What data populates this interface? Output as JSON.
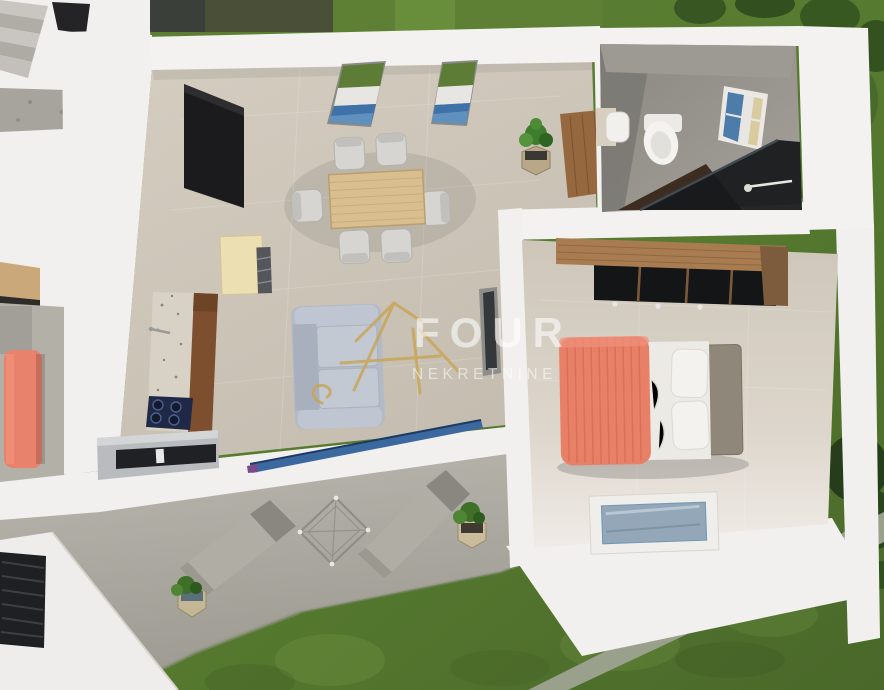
{
  "meta": {
    "type": "3d-floorplan-render",
    "description": "Top-down 3D architectural render of a one-bedroom apartment with garden, terrace and adjacent unit"
  },
  "watermark": {
    "brand": "FOUR",
    "subtitle": "NEKRETNINE",
    "logo": "four-house-logo",
    "logo_color": "#c9a452",
    "text_color": "rgba(255,255,255,0.58)"
  },
  "rooms": [
    {
      "name": "living-dining-room"
    },
    {
      "name": "kitchen"
    },
    {
      "name": "bedroom"
    },
    {
      "name": "bathroom"
    },
    {
      "name": "hallway"
    },
    {
      "name": "adjacent-unit-staircase"
    },
    {
      "name": "terrace"
    },
    {
      "name": "garden"
    }
  ],
  "furniture": [
    "dining-table",
    "dining-chair-x6",
    "sofa",
    "tv-panel",
    "kitchen-counter",
    "cooktop",
    "sideboard",
    "dresser",
    "standing-mirror",
    "potted-plant-x4",
    "double-bed",
    "wardrobe",
    "toilet",
    "washbasin",
    "shower-enclosure",
    "lounge-chair-x2",
    "glass-table",
    "skylight-window"
  ],
  "palette": {
    "grass": "#5e8135",
    "grass_dark": "#31501f",
    "terrace_concrete": "#b5b2aa",
    "wall_white": "#f2f0ee",
    "floor_tile": "#cfc8bb",
    "bed_blanket_coral": "#e87f67",
    "sofa_gray": "#b3bac6",
    "wood_light": "#d9bf8f",
    "wood_dark": "#a87c50",
    "cooktop_navy": "#1f2945",
    "window_glass_blue": "#4470a4",
    "shower_glass_dark": "#17191b"
  }
}
